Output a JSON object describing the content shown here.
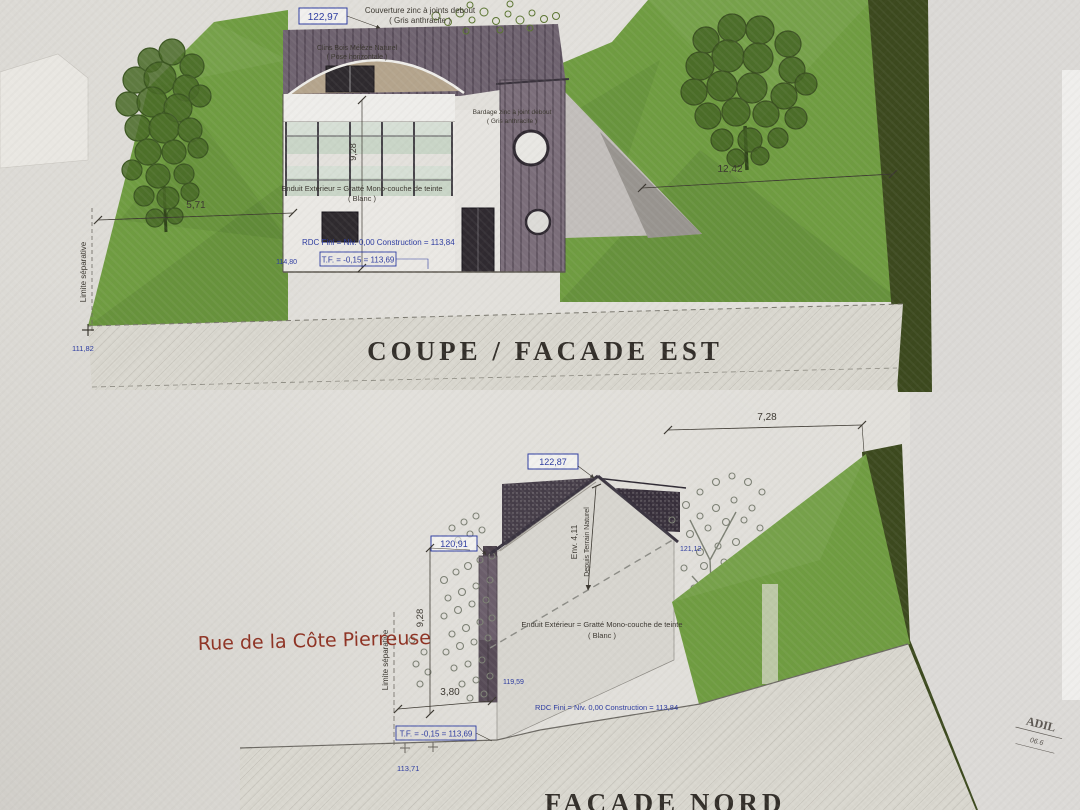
{
  "palette": {
    "paper": "#e0ded9",
    "terrain_green": "#6f9c41",
    "dark_green_band": "#3c491e",
    "zinc_cladding": "#7b6e7a",
    "annotation_blue": "#2b3aa0",
    "annotation_red": "#8e3122",
    "ink": "#3a362f"
  },
  "common": {
    "enduit_note_1": "Enduit Extérieur = Gratté Mono-couche de teinte",
    "enduit_note_2": "( Blanc )",
    "rdc_line": "RDC Fini  =  Niv. 0,00 Construction = 113,84",
    "tf_line": "T.F.  = -0,15  = 113,69",
    "limite_label": "Limite séparative"
  },
  "top_drawing": {
    "title": "COUPE / FACADE  EST",
    "level_peak": "122,97",
    "level_left": "114,80",
    "level_ground": "111,82",
    "dim_height": "9,28",
    "dim_left": "5,71",
    "dim_right": "12,42",
    "couverture_note_1": "Couverture zinc à joints debout",
    "couverture_note_2": "( Gris anthracite )",
    "clins_note_1": "Clins Bois Mélèze Naturel",
    "clins_note_2": "( Pose horizontale )",
    "bardage_note_1": "Bardage zinc à joint debout",
    "bardage_note_2": "( Gris anthracite )"
  },
  "bottom_drawing": {
    "title": "FACADE  NORD",
    "street": "Rue de la Côte Pierreuse",
    "level_ridge": "122,87",
    "level_left": "120,91",
    "level_right": "121,12",
    "level_base": "119,59",
    "level_ground": "113,71",
    "dim_top": "7,28",
    "dim_height": "9,28",
    "dim_width": "3,80",
    "env_note_1": "Env.  4,11",
    "env_note_2": "Depuis Terrain Naturel"
  },
  "stamp": {
    "line1": "ADIL",
    "line2": "06.6"
  }
}
